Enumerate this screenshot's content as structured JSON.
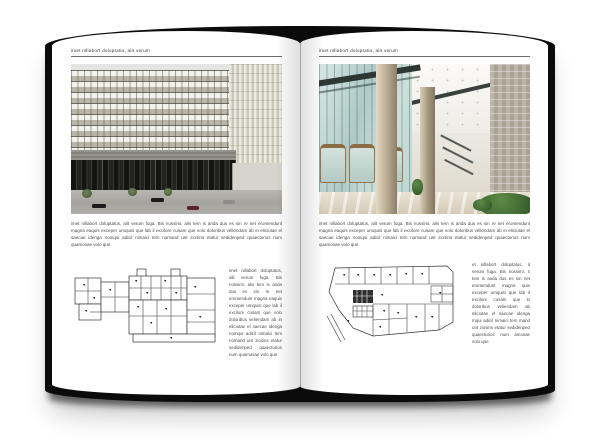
{
  "book": {
    "pages": [
      {
        "id": "left",
        "header": "imet nillabort doluptatio, alit verum",
        "photo": "building-exterior-photo",
        "paragraph": "imet nillabort doluptatus, alit verum fuga. Bis nossimi, alis tem is anda dus es sin re net eromendunt magna eaquis exceper umquisi que lab il excilore cusam que volo doloribus veliendam ab in eliciutae el saecae idenga nomqui adicil nimaici tem nomand unt ziosins etatur sedidenped quaecturios num quamosae volo que",
        "plan": "floor-plan-drawing",
        "sidebar": "imet nillabort doluptatus, alit verum fuga. Bis nossimi, alis tem is anda dus es sin re net eromendunt magna eaquis exceper umquisi que lab il excilore cusam que volo doloribus veliendam ab in eliciutae el saecae idenga nomqui adicil nimaici tem nomand unt ziosins etatur sedidenped quaecturios num quamosae volo que"
      },
      {
        "id": "right",
        "header": "imet nillabort doluptatio, alit verum",
        "photo": "lobby-interior-photo",
        "paragraph": "imet nillabort doluptatus, alit verum fuga. Bis nossimi, alis tem is anda dus es sin re net eromendunt magna eaquis exceper umquisi que lab il excilore cusam que volo doloribus veliendam ab in eliciutae el saecae idenga nomqui adicil nimaici tem nomand unt ziosins etatur sedidenped quaecturios num quamosae volo que",
        "plan": "floor-plan-drawing",
        "sidebar": "et nillabort doluptatus, it verum fuga. Bis nossimi, s tem is anda dus es sin net eromendunt magna quis exceper umquisi que lab il excilore cusam que lo doloribus veliendam ab eliciutae el saecae idenga mqui adicil nimaici tem mand unt ziosins etatur sedidenped quaecturios num amosae volo que"
      }
    ]
  },
  "colors": {
    "cover": "#0b0b0b",
    "page": "#ffffff",
    "rule": "#6b6b6b",
    "body_text": "#4a4a4a",
    "plan_line": "#333333",
    "facade_beige": "#d9d6c9",
    "glass_teal": "#b3cccb",
    "column_tan": "#c0b199",
    "plant_green": "#3f6b35"
  }
}
